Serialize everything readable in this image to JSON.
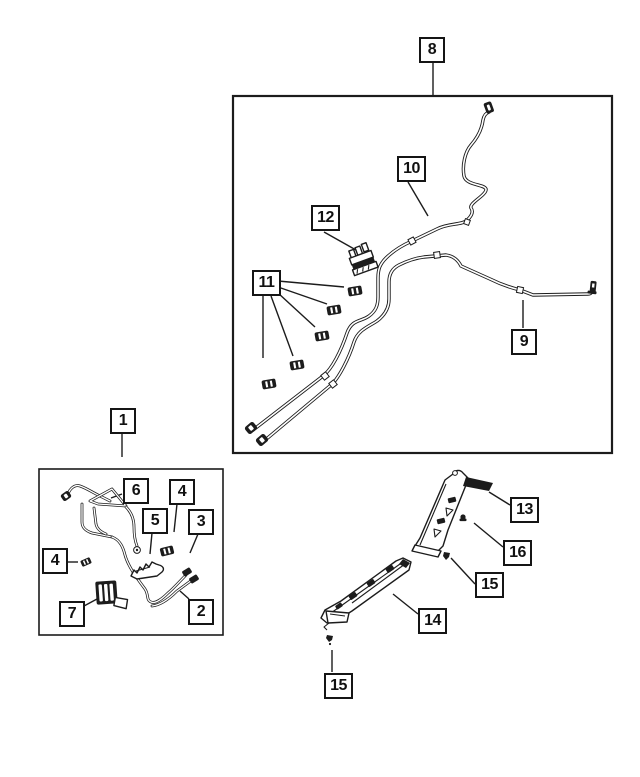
{
  "page": {
    "type": "exploded-parts-diagram",
    "ink_color": "#1c1c1c",
    "paper_color": "#ffffff"
  },
  "diagram": {
    "callouts": [
      {
        "label": "8"
      },
      {
        "label": "10"
      },
      {
        "label": "12"
      },
      {
        "label": "11"
      },
      {
        "label": "9"
      },
      {
        "label": "1"
      },
      {
        "label": "6"
      },
      {
        "label": "4"
      },
      {
        "label": "5"
      },
      {
        "label": "3"
      },
      {
        "label": "4"
      },
      {
        "label": "7"
      },
      {
        "label": "2"
      },
      {
        "label": "13"
      },
      {
        "label": "16"
      },
      {
        "label": "15"
      },
      {
        "label": "14"
      },
      {
        "label": "15"
      }
    ]
  }
}
